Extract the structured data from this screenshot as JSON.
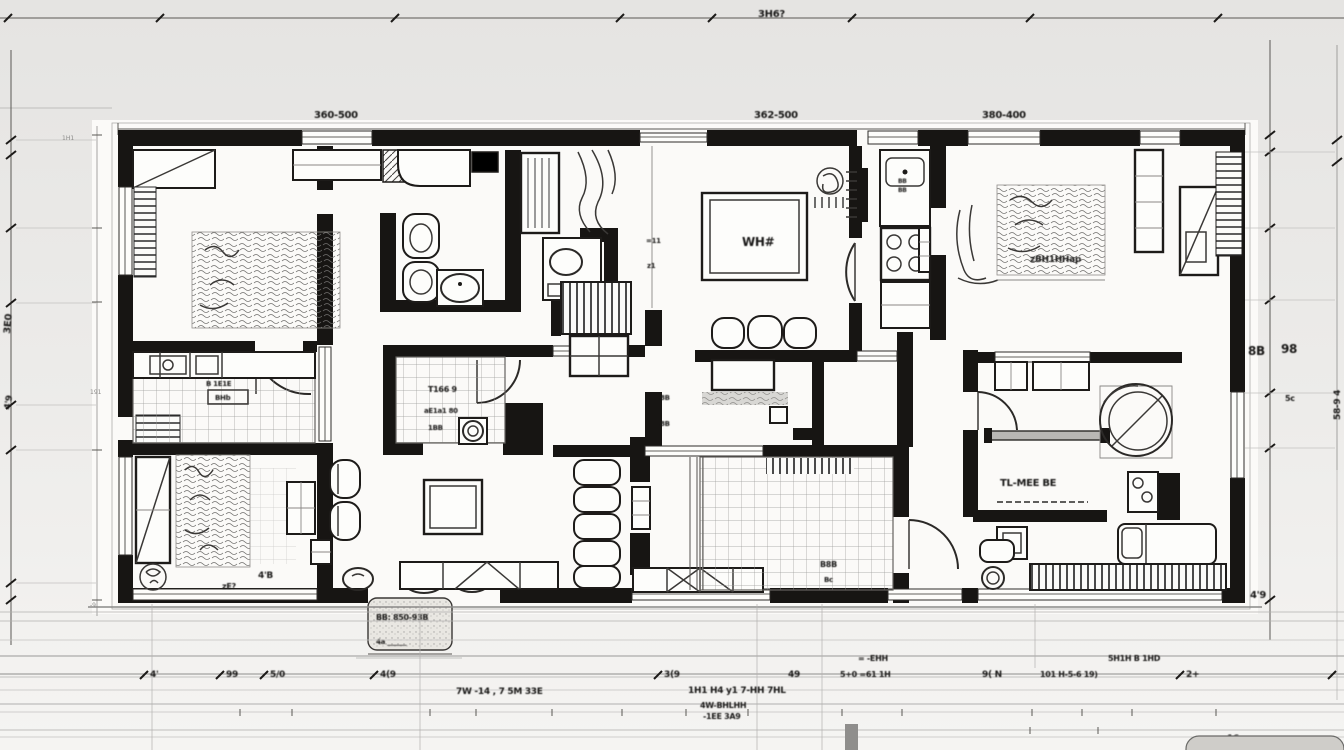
{
  "title": "architectural-floor-plan-blueprint",
  "colors": {
    "background_top": "#e5e4e2",
    "background_bottom": "#f5f4f2",
    "paper": "#fbfaf8",
    "wall_ink": "#171513",
    "line_ink": "#55534f",
    "grid_line": "#9a9a98",
    "blob_gray": "#cfcdc9"
  },
  "rulers": {
    "top": {
      "label": "3H6?"
    },
    "plan_width": {
      "labels": [
        "360-500",
        "362-500",
        "380-400"
      ]
    },
    "left": {
      "rot_a": "3E0",
      "rot_b": "4'9",
      "tiny_a": "1H1",
      "tiny_b": "191",
      "tiny_c": "-9"
    },
    "right": {
      "pair_a": "8B",
      "pair_b": "98",
      "small": "5c",
      "low": "4'9",
      "far": "58-9 4"
    },
    "bottom": {
      "row": [
        "4'",
        "99",
        "5/0",
        "4(9",
        "3(9",
        "49",
        "5+0 =61 1H",
        "9( N",
        "101 H-5-6 19)",
        "2+"
      ],
      "small_a": "= -EHH",
      "small_b": "5H1H B 1HD",
      "notes": [
        "7W -14 , 7 5M 33E",
        "1H1 H4 y1 7-HH 7HL",
        "4W-BHLHH",
        "-1EE 3A9"
      ],
      "corner": "16"
    }
  },
  "rooms": {
    "entry_porch": {
      "line1": "BB: 850-93B",
      "line2": "4a ______"
    },
    "kitchen_left": {
      "label_a": "B 1E1E",
      "label_b": "BHb"
    },
    "kitchen_mid": {
      "line1": "T166 9",
      "line2": "aE1a1 80",
      "line3": "1BB"
    },
    "lounge": {
      "table_glyph": "WH#"
    },
    "hall": {
      "glyph_a": "8B",
      "glyph_b": "8B"
    },
    "corridor": {
      "glyph_a": "=11",
      "glyph_b": "z1"
    },
    "terrace": {
      "glyph_a": "B8B",
      "glyph_b": "Bc"
    },
    "bedroom_top_right": {
      "rug_label": "zBH1HHap",
      "tiny_a": "BB",
      "tiny_b": "BB"
    },
    "bedroom_mid_right": {
      "label": "TL-MEE BE"
    },
    "bedroom_bottom_left": {
      "label_a": "4'B",
      "label_b": "zE?"
    }
  }
}
